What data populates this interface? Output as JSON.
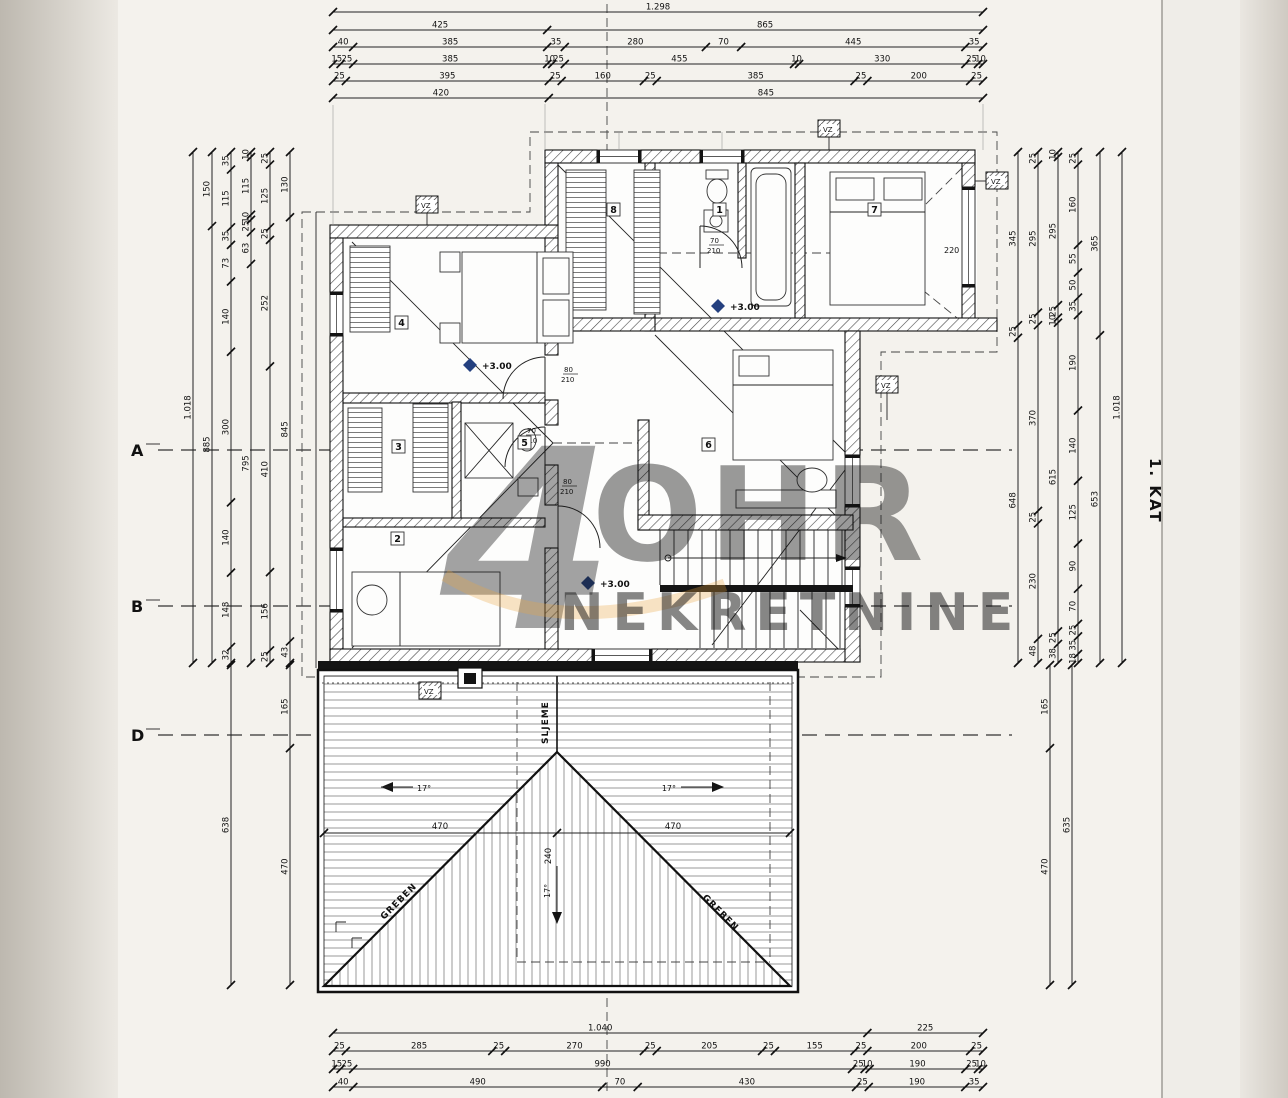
{
  "title": {
    "floor": "1. KAT"
  },
  "axis": {
    "a": "A",
    "b": "B",
    "d": "D"
  },
  "rooms": {
    "r1": "1",
    "r2": "2",
    "r3": "3",
    "r4": "4",
    "r5": "5",
    "r6": "6",
    "r7": "7",
    "r8": "8"
  },
  "levels": {
    "m1": "+3.00",
    "m2": "+3.00",
    "m3": "+3.00"
  },
  "roof": {
    "ridge": "SLJEME",
    "greben_left": "GREBEN",
    "greben_right": "GREBEN",
    "slope_left": "17°",
    "slope_right": "17°",
    "slope_center": "17°",
    "dim_left": "470",
    "dim_right": "470",
    "dim_center": "240"
  },
  "marks": {
    "vz": "VZ",
    "window": "220"
  },
  "doors": {
    "d1_w": "80",
    "d1_h": "210",
    "d2_w": "70",
    "d2_h": "210",
    "d3_w": "80",
    "d3_h": "210",
    "d4_w": "70",
    "d4_h": "210"
  },
  "watermark": {
    "numeral": "4",
    "letters": "OHR",
    "subtitle": "NEKRETNINE"
  },
  "dims": {
    "top": [
      [
        "1.298"
      ],
      [
        "425",
        "865"
      ],
      [
        "40",
        "385",
        "35",
        "280",
        "70",
        "445",
        "35"
      ],
      [
        "15",
        "25",
        "385",
        "10",
        "25",
        "455",
        "10",
        "330",
        "25",
        "10"
      ],
      [
        "25",
        "395",
        "25",
        "160",
        "25",
        "385",
        "25",
        "200",
        "25"
      ],
      [
        "420",
        "845"
      ]
    ],
    "bottom": [
      [
        "1.040",
        "225"
      ],
      [
        "25",
        "285",
        "25",
        "270",
        "25",
        "205",
        "25",
        "155",
        "25",
        "200",
        "25"
      ],
      [
        "15",
        "25",
        "990",
        "25",
        "10",
        "190",
        "25",
        "10"
      ],
      [
        "40",
        "490",
        "70",
        "430",
        "25",
        "190",
        "35"
      ]
    ],
    "left": [
      [
        "1.018"
      ],
      [
        "150",
        "885"
      ],
      [
        "35",
        "115",
        "35",
        "73",
        "140",
        "300",
        "140",
        "148",
        "32"
      ],
      [
        "10",
        "115",
        "10",
        "25",
        "63",
        "795"
      ],
      [
        "25",
        "125",
        "25",
        "252",
        "410",
        "156",
        "25"
      ],
      [
        "130",
        "845",
        "43"
      ]
    ],
    "right": [
      [
        "345",
        "25",
        "648"
      ],
      [
        "25",
        "295",
        "25",
        "370",
        "25",
        "230",
        "48"
      ],
      [
        "10",
        "295",
        "25",
        "10",
        "615",
        "25",
        "38"
      ],
      [
        "25",
        "160",
        "55",
        "50",
        "35",
        "190",
        "140",
        "125",
        "90",
        "70",
        "25",
        "35",
        "18"
      ],
      [
        "365",
        "653"
      ],
      [
        "1.018"
      ]
    ],
    "left_roof": [
      [
        "638"
      ],
      [
        "165",
        "470"
      ]
    ],
    "right_roof": [
      [
        "165",
        "470"
      ],
      [
        "635"
      ]
    ]
  }
}
